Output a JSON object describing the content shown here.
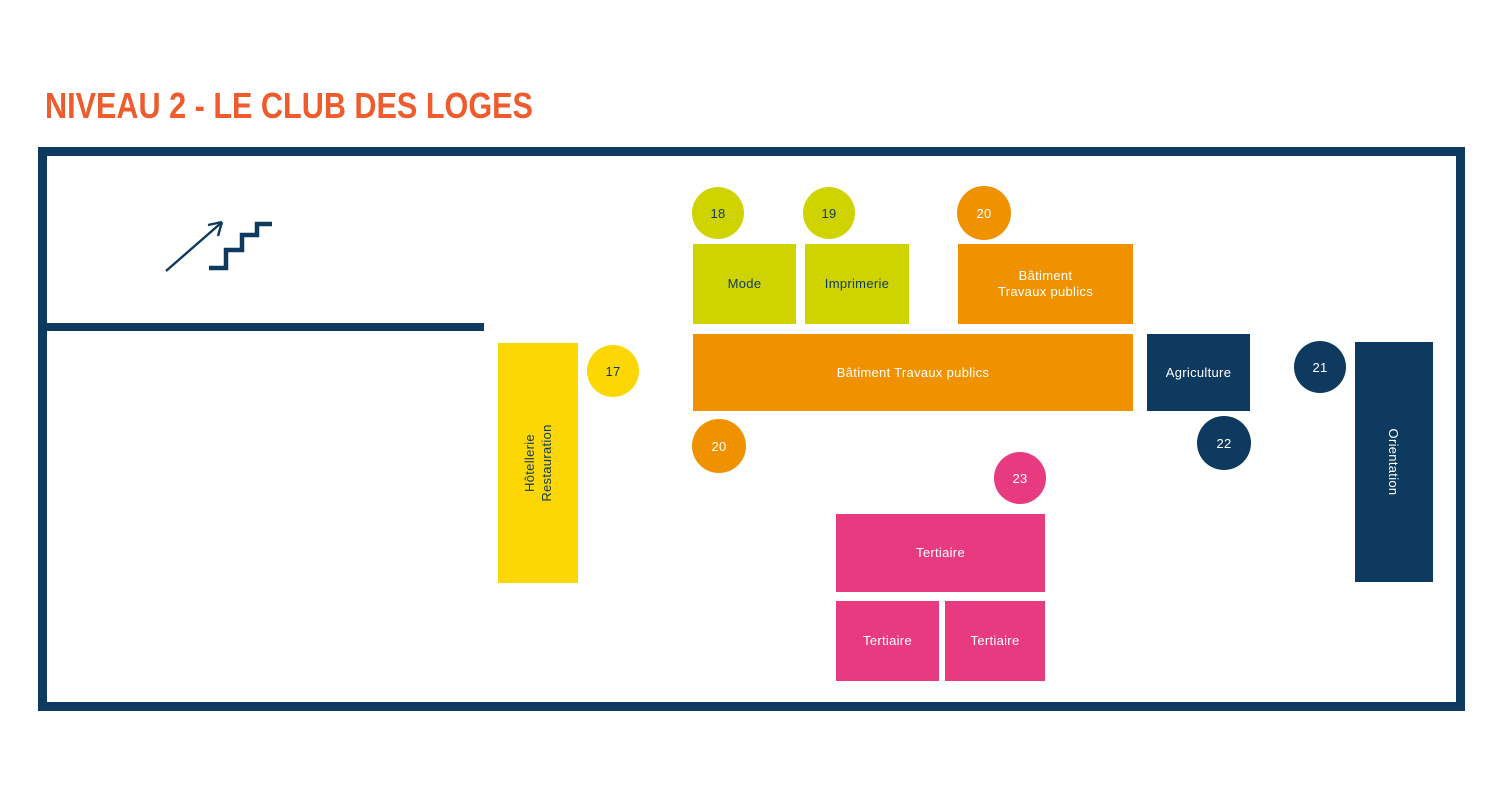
{
  "title": {
    "text": "NIVEAU 2 - LE CLUB DES LOGES"
  },
  "colors": {
    "navy": "#0d3a5e",
    "orange": "#f09200",
    "chartreuse": "#cfd400",
    "yellow": "#fcd703",
    "pink": "#e73a80",
    "title_orange": "#ee5b2d"
  },
  "map": {
    "frame": {
      "x": 38,
      "y": 147,
      "w": 1427,
      "h": 564,
      "stroke": 9
    },
    "interior_wall": {
      "x": 40,
      "y": 323,
      "w": 444,
      "h": 8
    },
    "stairs_icon": "stairs-up-arrow",
    "rooms": [
      {
        "id": "mode",
        "lines": [
          "Mode"
        ],
        "x": 693,
        "y": 244,
        "w": 103,
        "h": 80,
        "fill": "#cfd400",
        "text": "#0d3a5e"
      },
      {
        "id": "imprimerie",
        "lines": [
          "Imprimerie"
        ],
        "x": 805,
        "y": 244,
        "w": 104,
        "h": 80,
        "fill": "#cfd400",
        "text": "#0d3a5e"
      },
      {
        "id": "batiment-travaux-publics-upper",
        "lines": [
          "Bâtiment",
          "Travaux publics"
        ],
        "x": 958,
        "y": 244,
        "w": 175,
        "h": 80,
        "fill": "#f09200",
        "text": "#ffffff"
      },
      {
        "id": "batiment-travaux-publics-main",
        "lines": [
          "Bâtiment Travaux publics"
        ],
        "x": 693,
        "y": 334,
        "w": 440,
        "h": 77,
        "fill": "#f09200",
        "text": "#ffffff"
      },
      {
        "id": "agriculture",
        "lines": [
          "Agriculture"
        ],
        "x": 1147,
        "y": 334,
        "w": 103,
        "h": 77,
        "fill": "#0d3a5e",
        "text": "#ffffff"
      },
      {
        "id": "hotellerie-restauration",
        "lines": [
          "Hôtellerie",
          "Restauration"
        ],
        "x": 498,
        "y": 343,
        "w": 80,
        "h": 240,
        "fill": "#fcd703",
        "text": "#0d3a5e",
        "rotate": "up"
      },
      {
        "id": "orientation",
        "lines": [
          "Orientation"
        ],
        "x": 1355,
        "y": 342,
        "w": 78,
        "h": 240,
        "fill": "#0d3a5e",
        "text": "#ffffff",
        "rotate": "down"
      },
      {
        "id": "tertiaire-main",
        "lines": [
          "Tertiaire"
        ],
        "x": 836,
        "y": 514,
        "w": 209,
        "h": 78,
        "fill": "#e73a80",
        "text": "#ffffff"
      },
      {
        "id": "tertiaire-left",
        "lines": [
          "Tertiaire"
        ],
        "x": 836,
        "y": 601,
        "w": 103,
        "h": 80,
        "fill": "#e73a80",
        "text": "#ffffff"
      },
      {
        "id": "tertiaire-right",
        "lines": [
          "Tertiaire"
        ],
        "x": 945,
        "y": 601,
        "w": 100,
        "h": 80,
        "fill": "#e73a80",
        "text": "#ffffff"
      }
    ],
    "badges": [
      {
        "number": "17",
        "cx": 613,
        "cy": 371,
        "r": 26,
        "fill": "#fcd703",
        "text": "#0d3a5e"
      },
      {
        "number": "18",
        "cx": 718,
        "cy": 213,
        "r": 26,
        "fill": "#cfd400",
        "text": "#0d3a5e"
      },
      {
        "number": "19",
        "cx": 829,
        "cy": 213,
        "r": 26,
        "fill": "#cfd400",
        "text": "#0d3a5e"
      },
      {
        "number": "20",
        "cx": 984,
        "cy": 213,
        "r": 27,
        "fill": "#f09200",
        "text": "#ffffff"
      },
      {
        "number": "20",
        "cx": 719,
        "cy": 446,
        "r": 27,
        "fill": "#f09200",
        "text": "#ffffff"
      },
      {
        "number": "21",
        "cx": 1320,
        "cy": 367,
        "r": 26,
        "fill": "#0d3a5e",
        "text": "#ffffff"
      },
      {
        "number": "22",
        "cx": 1224,
        "cy": 443,
        "r": 27,
        "fill": "#0d3a5e",
        "text": "#ffffff"
      },
      {
        "number": "23",
        "cx": 1020,
        "cy": 478,
        "r": 26,
        "fill": "#e73a80",
        "text": "#ffffff"
      }
    ]
  }
}
